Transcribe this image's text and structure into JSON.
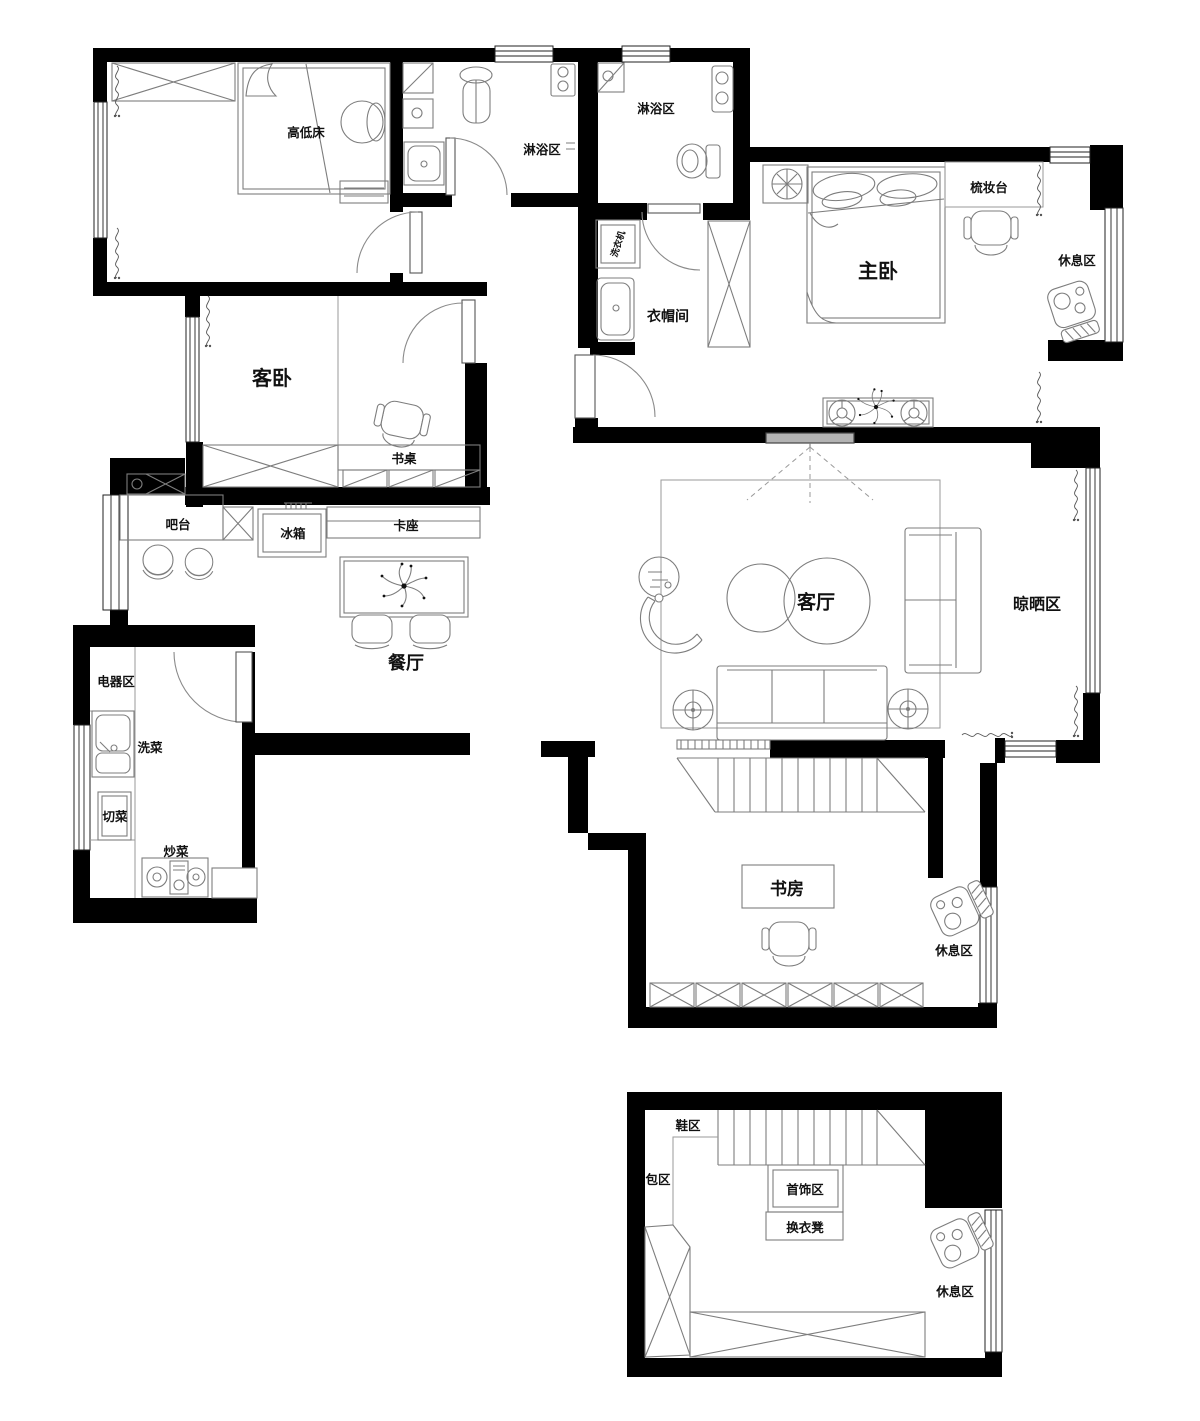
{
  "meta": {
    "type": "apartment-floor-plan",
    "width_px": 1200,
    "height_px": 1421
  },
  "colors": {
    "wall": "#000000",
    "furniture_line": "#7d7d7d",
    "text": "#111111",
    "projector_screen": "#b3b3b3",
    "background": "#ffffff"
  },
  "labels": {
    "kids_bed": "高低床",
    "shower_area_1": "淋浴区",
    "shower_area_2": "淋浴区",
    "master_bedroom": "主卧",
    "dressing_table": "梳妆台",
    "rest_area_master": "休息区",
    "guest_bedroom": "客卧",
    "desk": "书桌",
    "cloakroom": "衣帽间",
    "washing_machine": "洗衣机",
    "bar_counter": "吧台",
    "fridge": "冰箱",
    "booth_seat": "卡座",
    "dining_room": "餐厅",
    "appliance_area": "电器区",
    "wash_area": "洗菜",
    "cut_area": "切菜",
    "cook_area": "炒菜",
    "living_room": "客厅",
    "drying_area": "晾晒区",
    "study": "书房",
    "rest_area_study": "休息区",
    "shoe_area": "鞋区",
    "bag_area": "包区",
    "jewelry_area": "首饰区",
    "changing_stool": "换衣凳",
    "rest_area_closet": "休息区"
  }
}
